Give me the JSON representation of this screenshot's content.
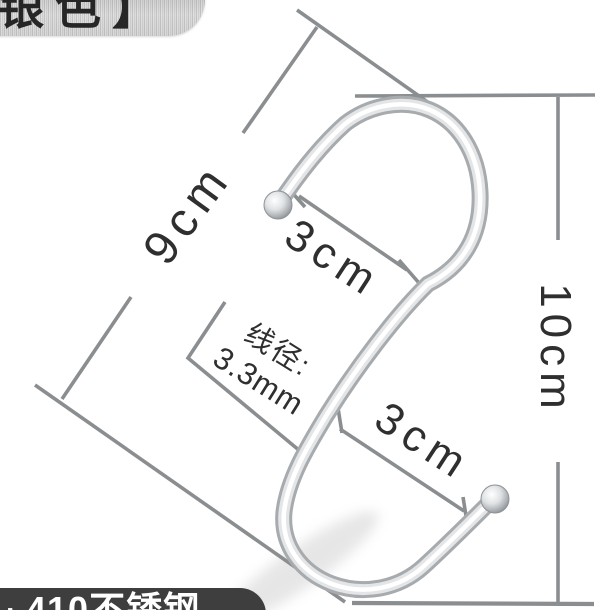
{
  "tags": {
    "top_color_tag": "银色】",
    "bottom_material_bullet": "·",
    "bottom_material_text": "410不锈钢"
  },
  "dimensions": {
    "side_length": "9cm",
    "top_opening": "3cm",
    "bottom_opening": "3cm",
    "overall_height": "10cm",
    "wire_diameter_label": "线径:",
    "wire_diameter_value": "3.3mm"
  },
  "colors": {
    "dimension_line": "#8b8e90",
    "annotation_text": "#2f2f2f",
    "bottom_tag_bg": "#3e3e3e",
    "top_tag_text": "#262626",
    "wire_edge": "#a7abae",
    "wire_mid": "#e3e5e7",
    "wire_highlight": "#ffffff"
  }
}
